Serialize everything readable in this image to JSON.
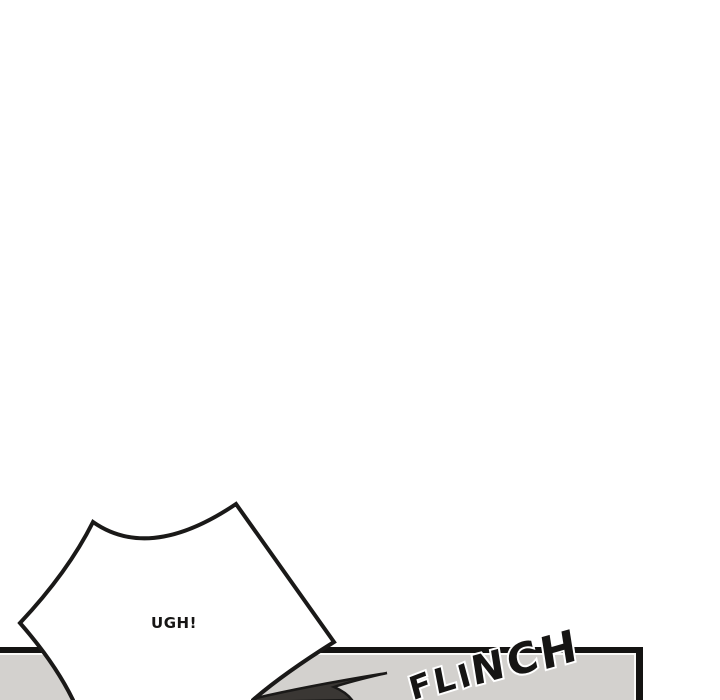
{
  "page": {
    "type": "webtoon-comic-strip",
    "background": "#ffffff"
  },
  "panel": {
    "fill": "#d3d1ce",
    "border_color": "#141312",
    "inner_highlight": "#fafaf8"
  },
  "speech_bubble": {
    "text": "UGH!",
    "shape": "spiky-burst",
    "fill": "#ffffff",
    "outline_color": "#1a1918"
  },
  "sfx": {
    "text": "FLINCH",
    "letters": [
      "F",
      "L",
      "I",
      "N",
      "C",
      "H"
    ],
    "color": "#161514",
    "halo_color": "#ffffff",
    "rotation_deg": -13
  },
  "impact_wedge": {
    "fill": "#3a3734",
    "outline_color": "#1a1918"
  }
}
